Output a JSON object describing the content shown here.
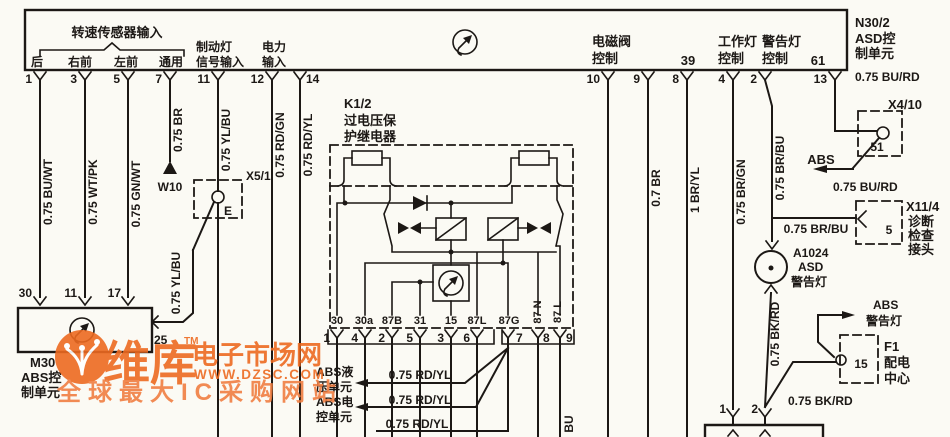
{
  "colors": {
    "ink": "#1c1815",
    "paper": "#fbfaf4",
    "watermark_primary": "#ed6a21",
    "watermark_secondary": "#f07e42"
  },
  "header": {
    "sensor_title": "转速传感器输入",
    "sensor_cols": [
      "后",
      "右前",
      "左前",
      "通用"
    ],
    "brake_line1": "制动灯",
    "brake_line2": "信号输入",
    "power_line1": "电力",
    "power_line2": "输入",
    "solenoid_line1": "电磁阀",
    "solenoid_line2": "控制",
    "num_39": "39",
    "work_line1": "工作灯",
    "work_line2": "控制",
    "warn_line1": "警告灯",
    "warn_line2": "控制",
    "num_61": "61"
  },
  "n30": {
    "line1": "N30/2",
    "line2": "ASD控",
    "line3": "制单元"
  },
  "top_pins": {
    "p1": "1",
    "p3": "3",
    "p5": "5",
    "p7": "7",
    "p11": "11",
    "p12": "12",
    "p14": "14",
    "p10": "10",
    "p9": "9",
    "p8": "8",
    "p4": "4",
    "p2": "2",
    "p13": "13"
  },
  "wires": {
    "w1": "0.75 BU/WT",
    "w3": "0.75 WT/PK",
    "w5": "0.75 GN/WT",
    "w7": "0.75 BR",
    "w11_upper": "0.75 YL/BU",
    "w11_lower": "0.75 YL/BU",
    "w12": "0.75 RD/GN",
    "w14": "0.75 RD/YL",
    "w9": "0.7 BR",
    "w8": "1 BR/YL",
    "w4": "0.75 BR/GN",
    "w2_vert": "0.75 BR/BU",
    "w2_horiz": "0.75 BR/BU",
    "w13_upper": "0.75 BU/RD",
    "w13_lower": "0.75 BU/RD",
    "lamp_wire": "0.75 BK/RD",
    "f1_wire": "0.75 BK/RD",
    "rd_yl_1": "0.75 RD/YL",
    "rd_yl_2": "0.75 RD/YL",
    "rd_yl_3": "0.75 RD/YL",
    "bu_fragment": "BU"
  },
  "ground": {
    "label": "W10"
  },
  "x5_1": {
    "name": "X5/1",
    "contact": "E",
    "pin": "25"
  },
  "m30": {
    "pin_30": "30",
    "pin_11": "11",
    "pin_17": "17",
    "line1": "M30",
    "line2": "ABS控",
    "line3": "制单元"
  },
  "relay": {
    "line1": "K1/2",
    "line2": "过电压保",
    "line3": "护继电器",
    "t30": "30",
    "t30a": "30a",
    "t87b": "87B",
    "t31": "31",
    "t15": "15",
    "t87l": "87L",
    "t87g": "87G",
    "t87n": "87 N",
    "t87l2": "87 L",
    "p1": "1",
    "p4": "4",
    "p2": "2",
    "p5": "5",
    "p3": "3",
    "p6": "6",
    "p7": "7",
    "p8": "8",
    "p9": "9"
  },
  "abs_units": {
    "hyd1": "ABS液",
    "hyd2": "压单元",
    "ecu1": "ABS电",
    "ecu2": "控单元"
  },
  "x4_10": {
    "name": "X4/10",
    "pin": "51",
    "abs_label": "ABS"
  },
  "x11_4": {
    "name": "X11/4",
    "pin": "5",
    "line1": "诊断",
    "line2": "检查",
    "line3": "接头"
  },
  "a1024": {
    "line1": "A1024",
    "line2": "ASD",
    "line3": "警告灯"
  },
  "f1": {
    "name": "F1",
    "line2": "配电",
    "line3": "中心",
    "pin": "15",
    "abs1": "ABS",
    "abs2": "警告灯"
  },
  "bottom_box": {
    "p1": "1",
    "p2": "2"
  },
  "watermark": {
    "brand": "维库",
    "tm": "TM",
    "suffix": "电子市场网",
    "url": "WWW.DZSC.COM",
    "tagline": "全球最大IC采购网站"
  }
}
